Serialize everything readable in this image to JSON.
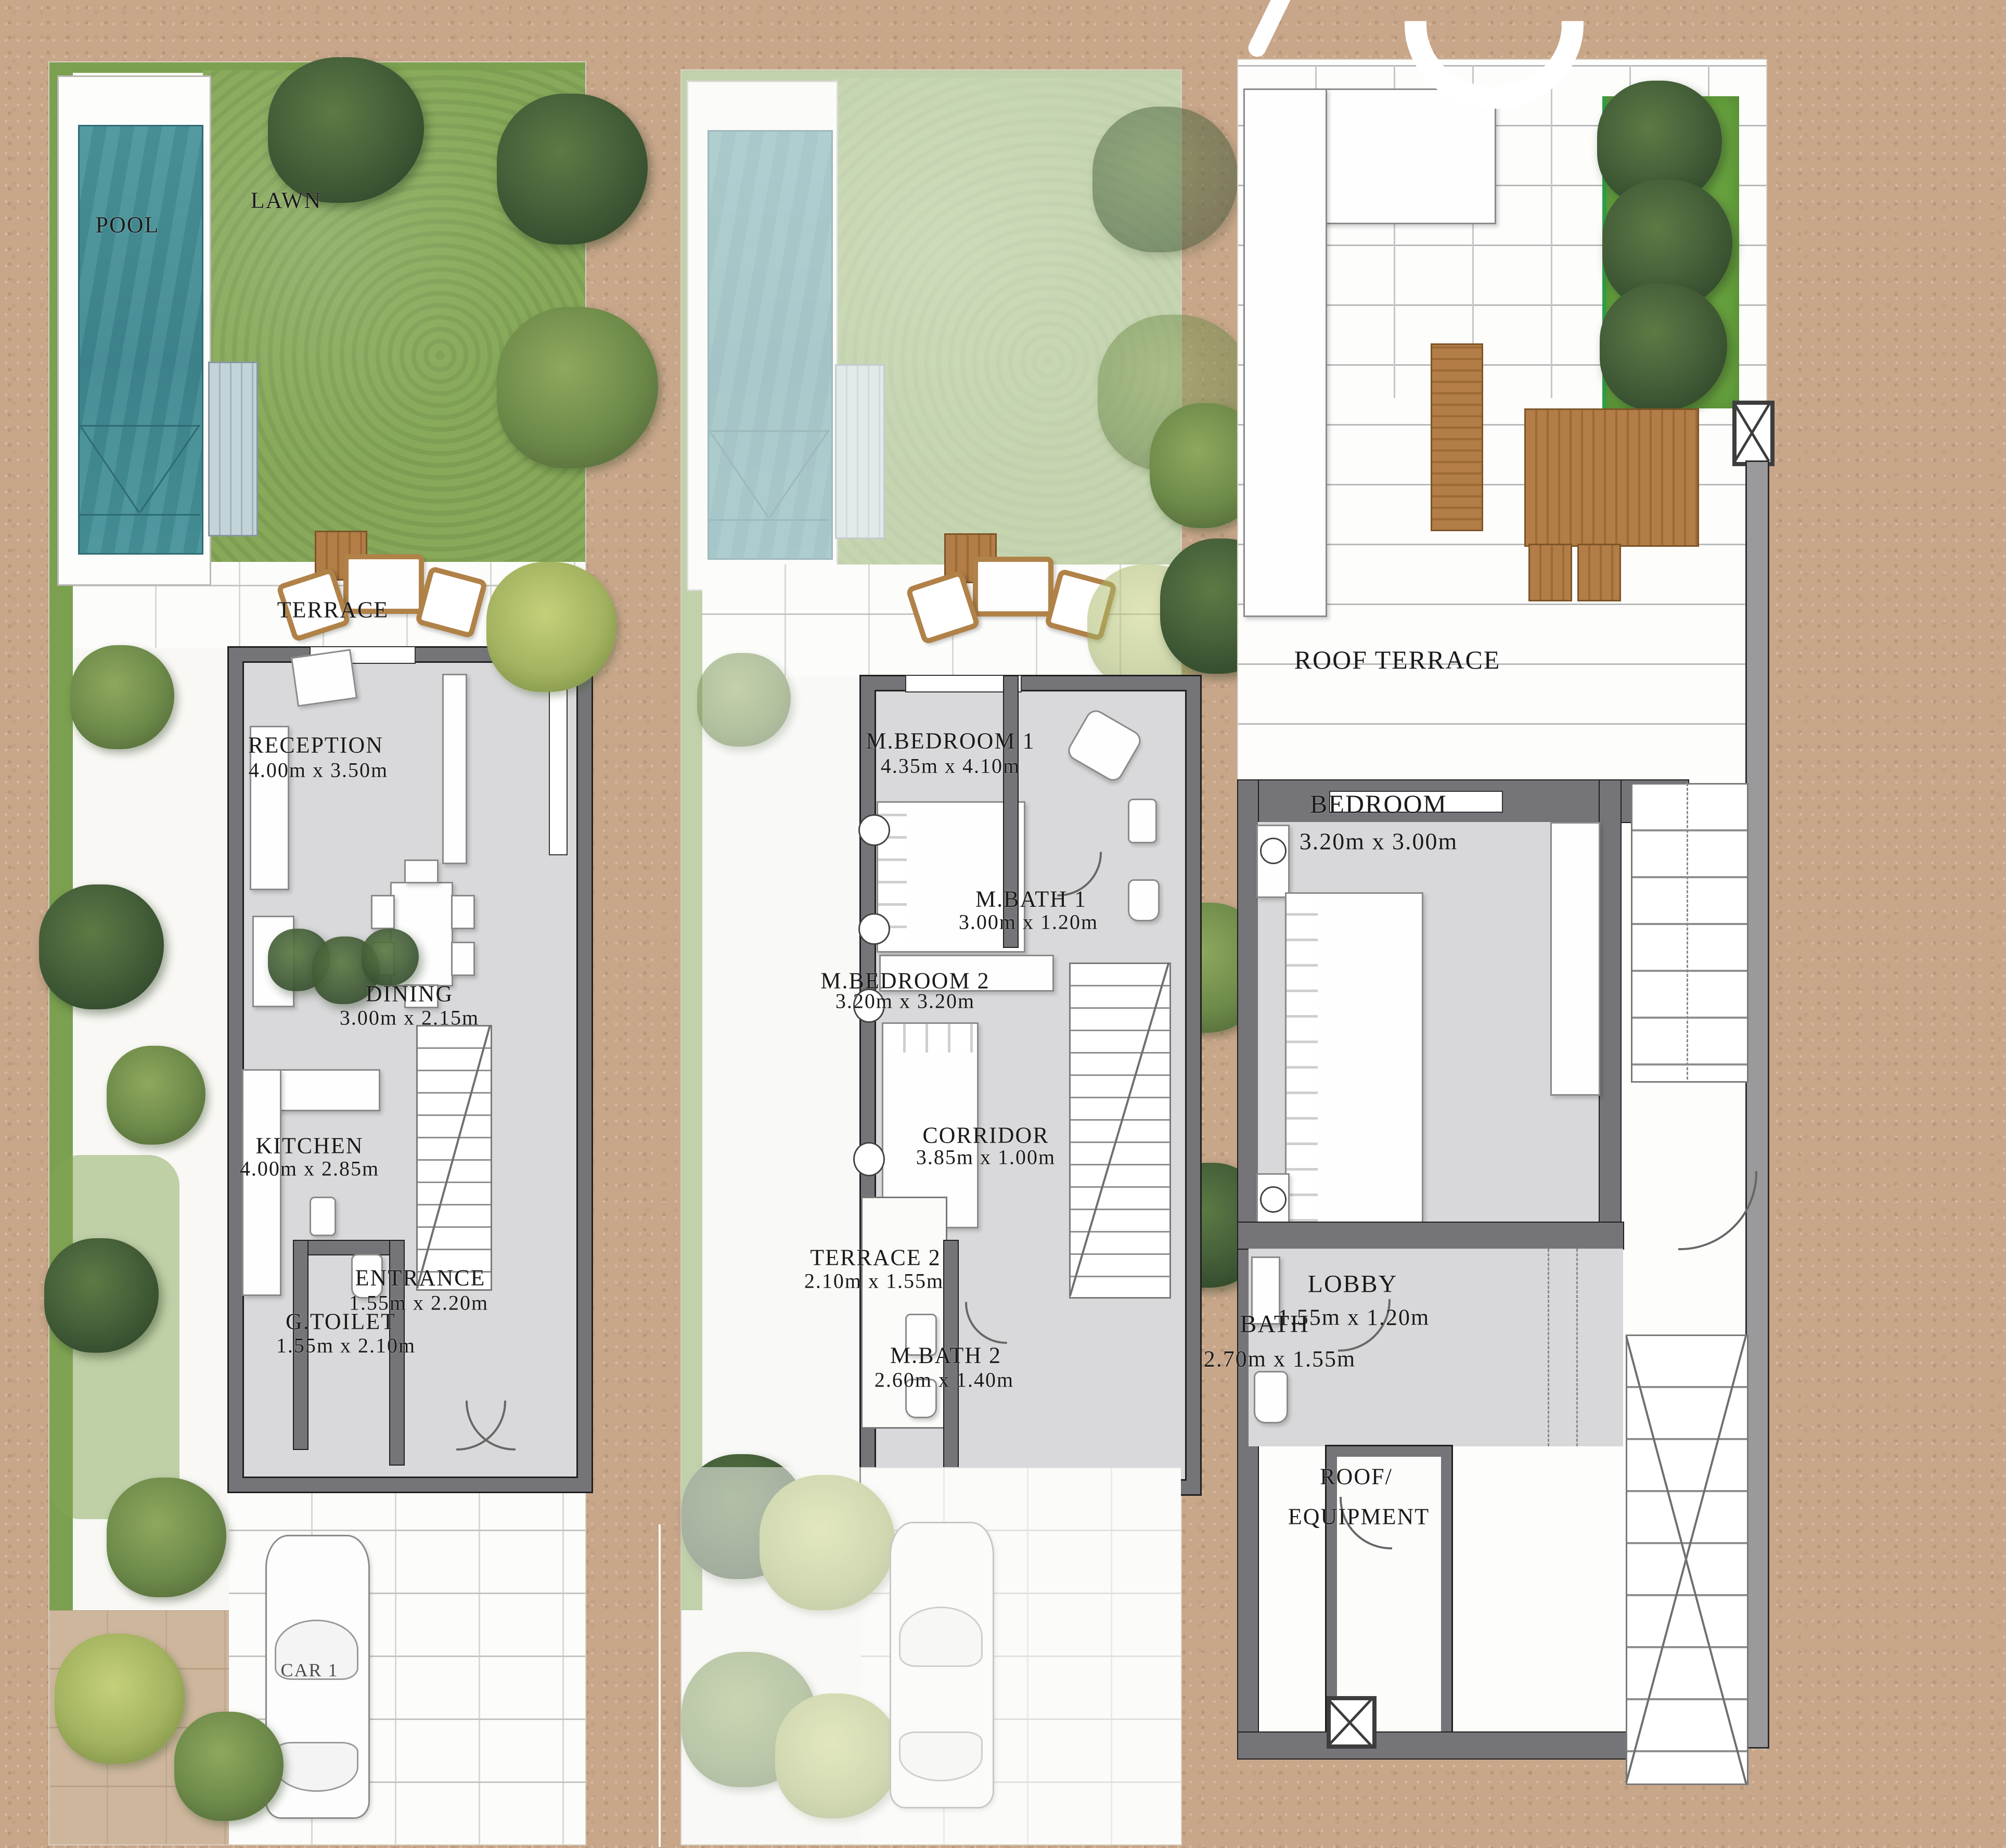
{
  "document_type": "architectural floor plans, three-level townhouse",
  "colors": {
    "background_sand": "#c8a68a",
    "pool_water": "#44909a",
    "lawn_green": "#87a959",
    "wall_gray": "#757579",
    "floor_gray": "#d9d9db",
    "wood_brown": "#b27d46",
    "planter_green": "#69a33f"
  },
  "plans": [
    {
      "id": "ground-floor",
      "rooms": [
        {
          "name": "POOL",
          "dims": ""
        },
        {
          "name": "LAWN",
          "dims": ""
        },
        {
          "name": "TERRACE",
          "dims": ""
        },
        {
          "name": "RECEPTION",
          "dims": "4.00m x 3.50m"
        },
        {
          "name": "DINING",
          "dims": "3.00m x 2.15m"
        },
        {
          "name": "KITCHEN",
          "dims": "4.00m x 2.85m"
        },
        {
          "name": "ENTRANCE",
          "dims": "1.55m x 2.20m"
        },
        {
          "name": "G.TOILET",
          "dims": "1.55m x 2.10m"
        },
        {
          "name": "CAR 1",
          "dims": ""
        }
      ]
    },
    {
      "id": "first-floor",
      "rooms": [
        {
          "name": "M.BEDROOM 1",
          "dims": "4.35m x 4.10m"
        },
        {
          "name": "M.BATH 1",
          "dims": "3.00m x 1.20m"
        },
        {
          "name": "M.BEDROOM 2",
          "dims": "3.20m x 3.20m"
        },
        {
          "name": "CORRIDOR",
          "dims": "3.85m x 1.00m"
        },
        {
          "name": "TERRACE 2",
          "dims": "2.10m x 1.55m"
        },
        {
          "name": "M.BATH 2",
          "dims": "2.60m x 1.40m"
        }
      ]
    },
    {
      "id": "roof",
      "rooms": [
        {
          "name": "ROOF TERRACE",
          "dims": ""
        },
        {
          "name": "BEDROOM",
          "dims": "3.20m x 3.00m"
        },
        {
          "name": "LOBBY",
          "dims": "1.55m x 1.20m"
        },
        {
          "name": "BATH",
          "dims": "2.70m x 1.55m"
        },
        {
          "name": "ROOF/",
          "name2": "EQUIPMENT",
          "dims": ""
        }
      ]
    }
  ]
}
